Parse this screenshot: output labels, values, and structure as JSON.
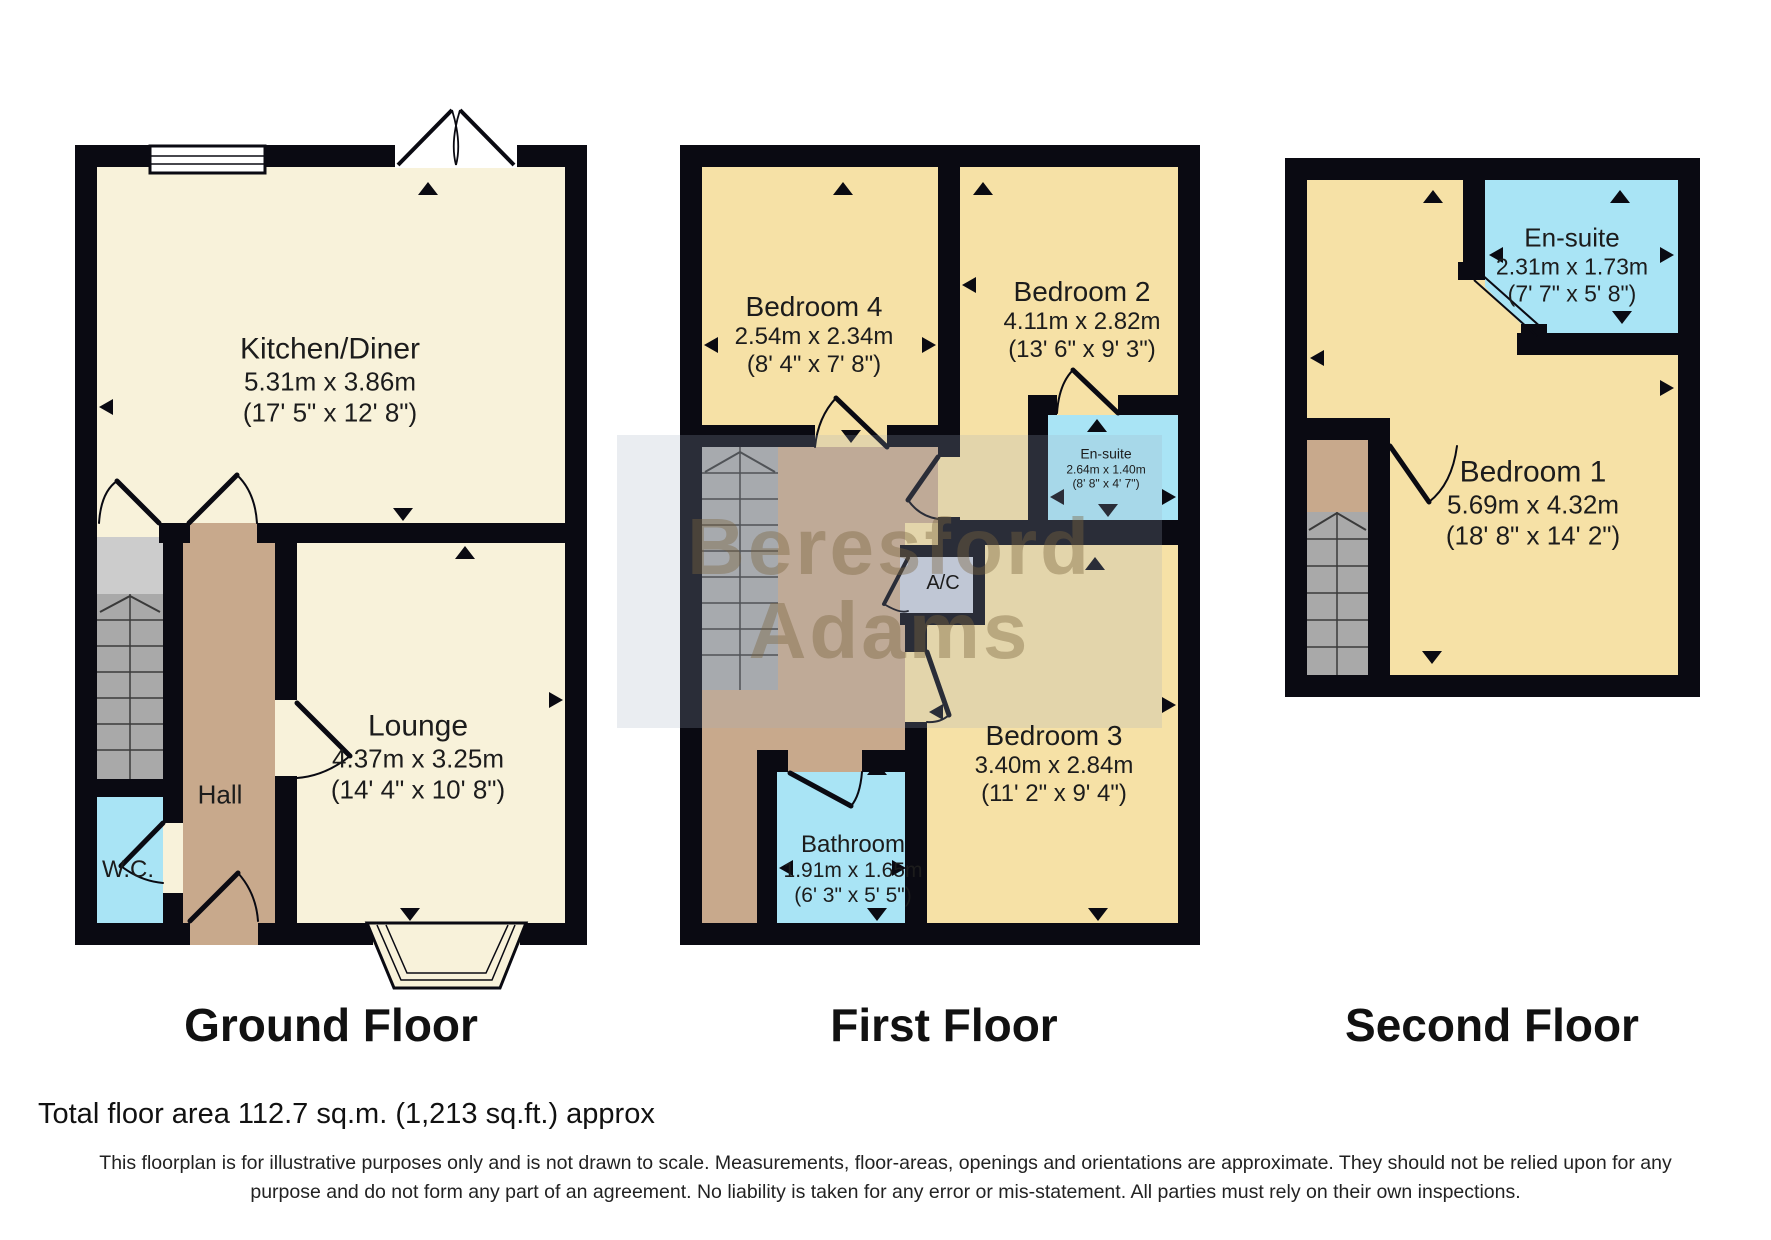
{
  "watermark": {
    "line1": "Beresford",
    "line2": "Adams"
  },
  "colors": {
    "wall": "#0a0a12",
    "room_cream": "#f8f2da",
    "room_wheat": "#f6e1a6",
    "hall_tan": "#c8a98c",
    "stairs_gray": "#a9a9a9",
    "store_gray": "#cccccc",
    "wet_room_cyan": "#a9e4f5",
    "ac_gray": "#c9cfdb",
    "watermark_text": "rgba(122,100,62,0.40)"
  },
  "floors": [
    {
      "id": "ground",
      "label": "Ground Floor"
    },
    {
      "id": "first",
      "label": "First Floor"
    },
    {
      "id": "second",
      "label": "Second Floor"
    }
  ],
  "rooms": {
    "kitchen": {
      "name": "Kitchen/Diner",
      "metric": "5.31m x 3.86m",
      "imperial": "(17' 5\" x 12' 8\")"
    },
    "lounge": {
      "name": "Lounge",
      "metric": "4.37m x 3.25m",
      "imperial": "(14' 4\" x 10' 8\")"
    },
    "hall": {
      "name": "Hall"
    },
    "wc": {
      "name": "W.C."
    },
    "bedroom4": {
      "name": "Bedroom 4",
      "metric": "2.54m x 2.34m",
      "imperial": "(8' 4\" x 7' 8\")"
    },
    "bedroom2": {
      "name": "Bedroom 2",
      "metric": "4.11m x 2.82m",
      "imperial": "(13' 6\" x 9' 3\")"
    },
    "ensuite_first": {
      "name": "En-suite",
      "metric": "2.64m x 1.40m",
      "imperial": "(8' 8\" x 4' 7\")"
    },
    "ac": {
      "name": "A/C"
    },
    "bedroom3": {
      "name": "Bedroom 3",
      "metric": "3.40m x 2.84m",
      "imperial": "(11' 2\" x 9' 4\")"
    },
    "bathroom": {
      "name": "Bathroom",
      "metric": "1.91m x 1.65m",
      "imperial": "(6' 3\" x 5' 5\")"
    },
    "ensuite_second": {
      "name": "En-suite",
      "metric": "2.31m x 1.73m",
      "imperial": "(7' 7\" x 5' 8\")"
    },
    "bedroom1": {
      "name": "Bedroom 1",
      "metric": "5.69m x 4.32m",
      "imperial": "(18' 8\" x 14' 2\")"
    }
  },
  "footer": {
    "total_area": "Total floor area 112.7 sq.m. (1,213 sq.ft.) approx",
    "disclaimer_line1": "This floorplan is for illustrative purposes only and is not drawn to scale. Measurements, floor-areas, openings and orientations are approximate. They should not be relied upon for any",
    "disclaimer_line2": "purpose and do not form any part of an agreement. No liability is taken for any error or mis-statement. All parties must rely on their own inspections."
  }
}
